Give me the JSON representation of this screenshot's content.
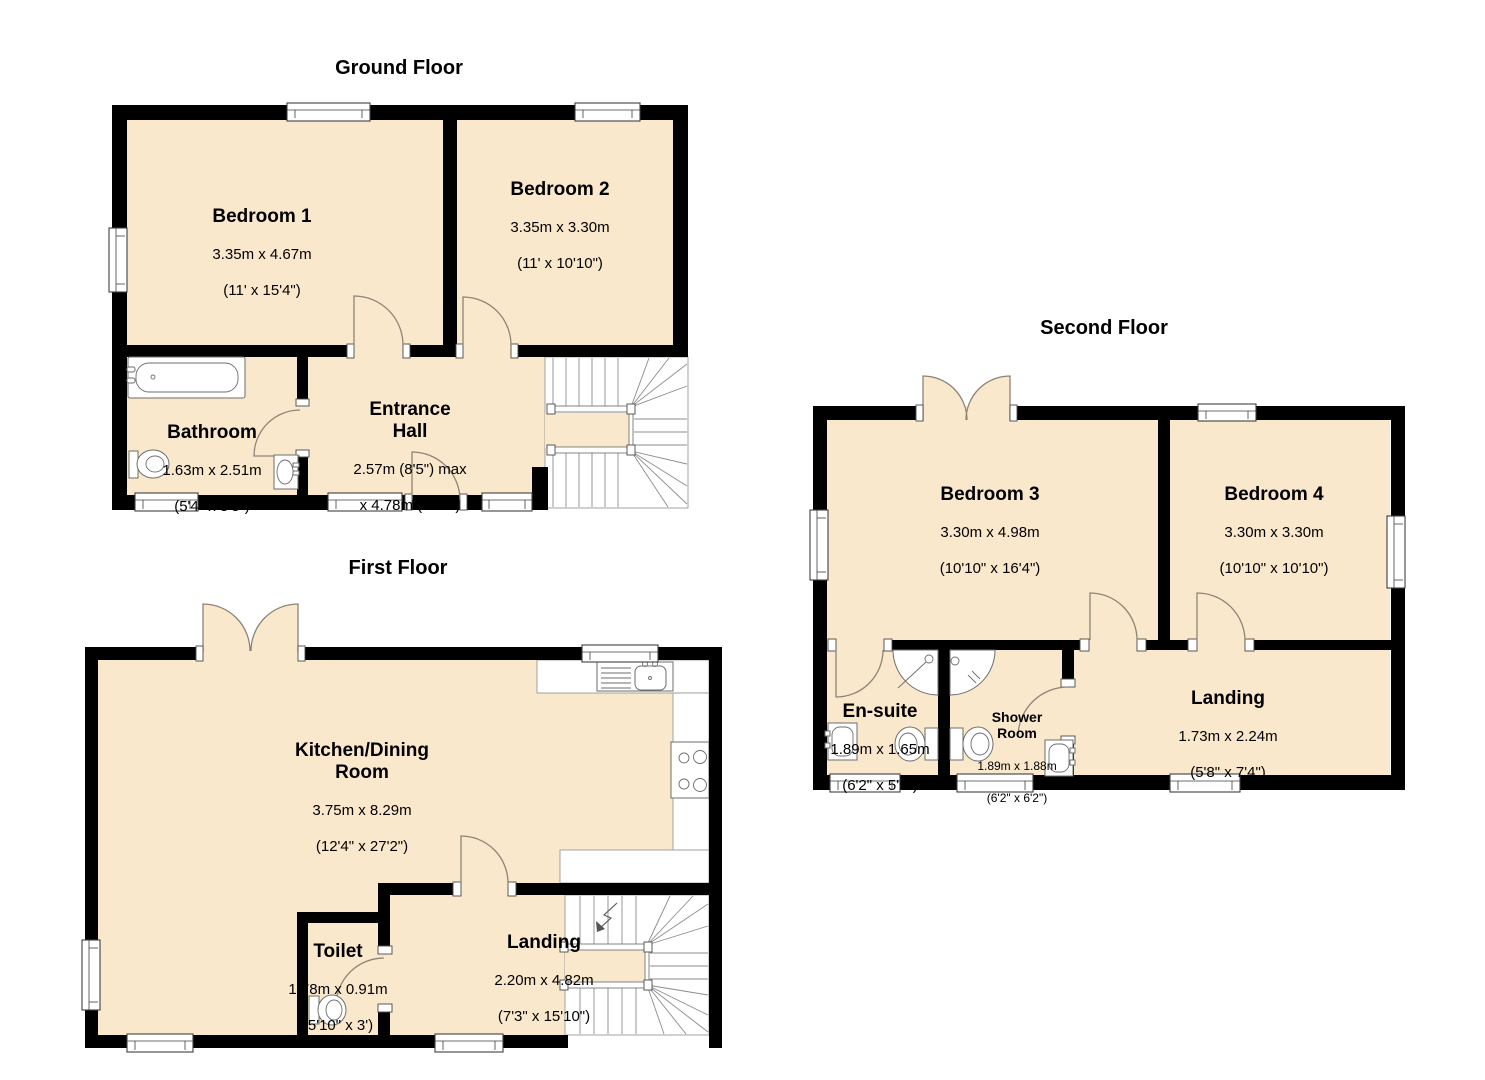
{
  "document": {
    "type": "property-floorplan",
    "background": "#ffffff"
  },
  "palette": {
    "room_fill": "#fae8cc",
    "wall": "#000000",
    "line": "#8d8478"
  },
  "fixtures_shown": [
    "bathtub",
    "toilet",
    "sink",
    "corner-shower",
    "kitchen-sink",
    "hob",
    "staircase",
    "window",
    "door-swing",
    "double-door"
  ],
  "floors": {
    "ground": {
      "title": "Ground Floor",
      "rooms": {
        "bedroom1": {
          "name": "Bedroom 1",
          "metric": "3.35m x 4.67m",
          "imperial": "(11' x 15'4\")"
        },
        "bedroom2": {
          "name": "Bedroom 2",
          "metric": "3.35m x 3.30m",
          "imperial": "(11' x 10'10\")"
        },
        "bathroom": {
          "name": "Bathroom",
          "metric": "1.63m x 2.51m",
          "imperial": "(5'4\" x 8'3\")"
        },
        "entrance_hall": {
          "name": "Entrance\nHall",
          "metric": "2.57m (8'5\") max",
          "imperial": "x 4.78m (15'8\")"
        }
      }
    },
    "first": {
      "title": "First Floor",
      "rooms": {
        "kitchen_dining": {
          "name": "Kitchen/Dining\nRoom",
          "metric": "3.75m x 8.29m",
          "imperial": "(12'4\" x 27'2\")"
        },
        "toilet": {
          "name": "Toilet",
          "metric": "1.78m x 0.91m",
          "imperial": "(5'10\" x 3')"
        },
        "landing": {
          "name": "Landing",
          "metric": "2.20m x 4.82m",
          "imperial": "(7'3\" x 15'10\")"
        }
      }
    },
    "second": {
      "title": "Second Floor",
      "rooms": {
        "bedroom3": {
          "name": "Bedroom 3",
          "metric": "3.30m x 4.98m",
          "imperial": "(10'10\" x 16'4\")"
        },
        "bedroom4": {
          "name": "Bedroom 4",
          "metric": "3.30m x 3.30m",
          "imperial": "(10'10\" x 10'10\")"
        },
        "ensuite": {
          "name": "En-suite",
          "metric": "1.89m x 1.65m",
          "imperial": "(6'2\" x 5'5\")"
        },
        "shower_room": {
          "name": "Shower\nRoom",
          "metric": "1.89m x 1.88m",
          "imperial": "(6'2\" x 6'2\")"
        },
        "landing": {
          "name": "Landing",
          "metric": "1.73m x 2.24m",
          "imperial": "(5'8\" x 7'4\")"
        }
      }
    }
  }
}
